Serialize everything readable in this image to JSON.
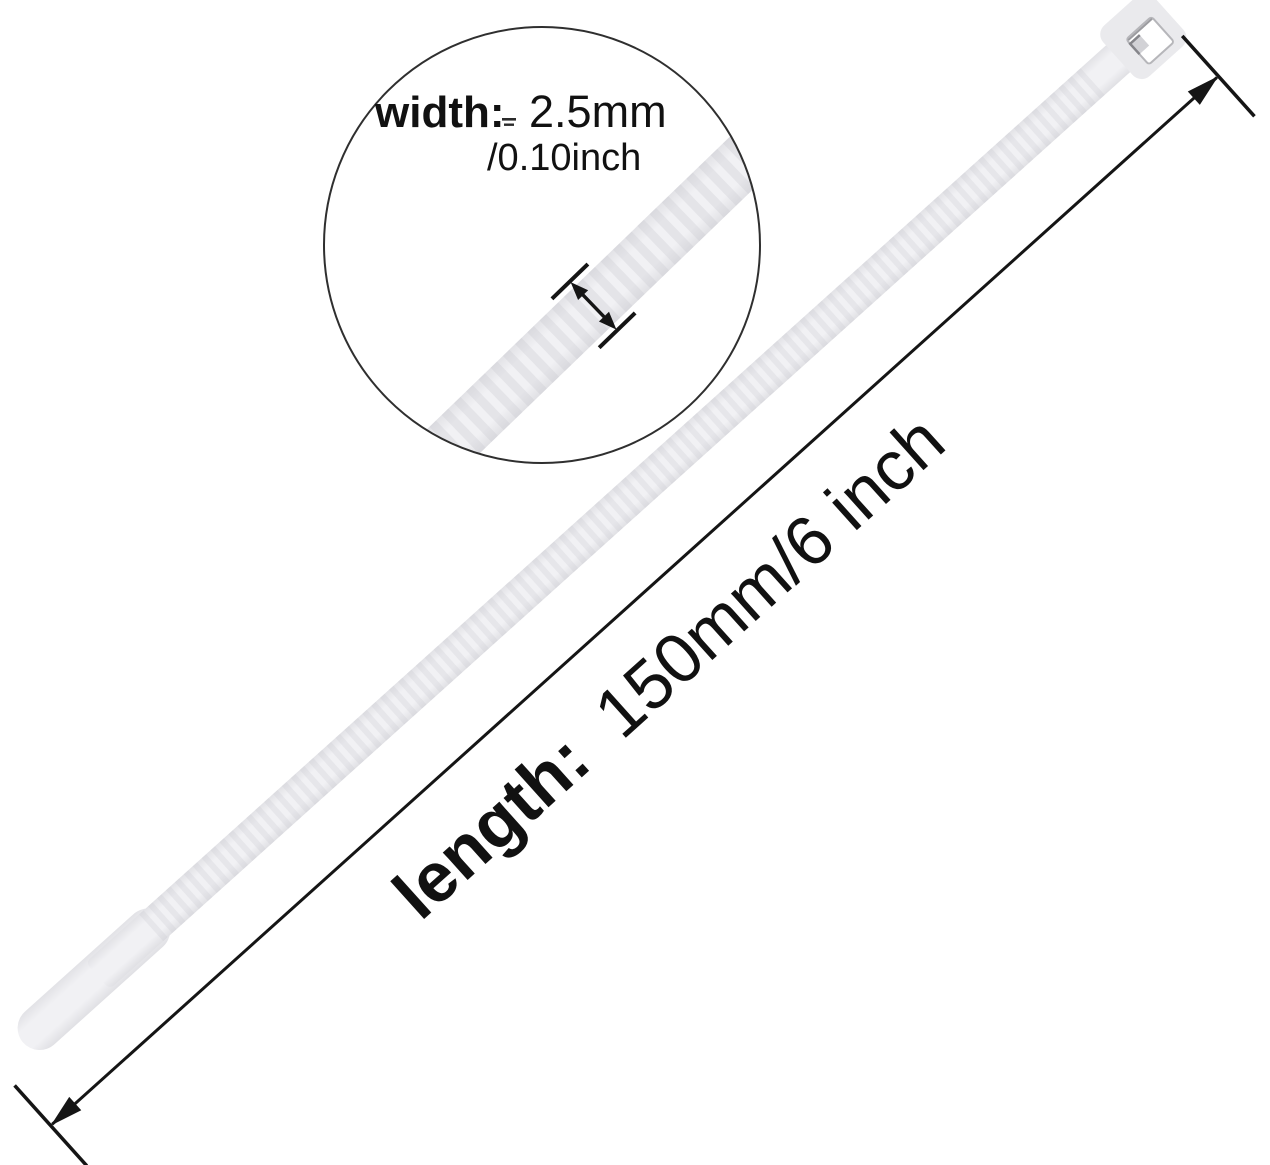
{
  "meta": {
    "description": "Product dimension diagram of a white nylon cable zip tie",
    "background": "#ffffff"
  },
  "labels": {
    "width": {
      "label": "width:",
      "metric": "2.5mm",
      "imperial": "/0.10inch"
    },
    "length": {
      "label": "length:",
      "value": "150mm/6 inch"
    }
  },
  "product": {
    "item": "cable-tie",
    "strap_color": "#efeff2",
    "strap_edge_color": "#e2e2e6",
    "tooth_color": "#c9c9d0",
    "head_color": "#eaeaed",
    "slot_color": "#ffffff",
    "pawl_color": "#d2d2d6"
  },
  "annotation": {
    "line_color": "#151515",
    "circle_outline_color": "#2f2f2f"
  }
}
